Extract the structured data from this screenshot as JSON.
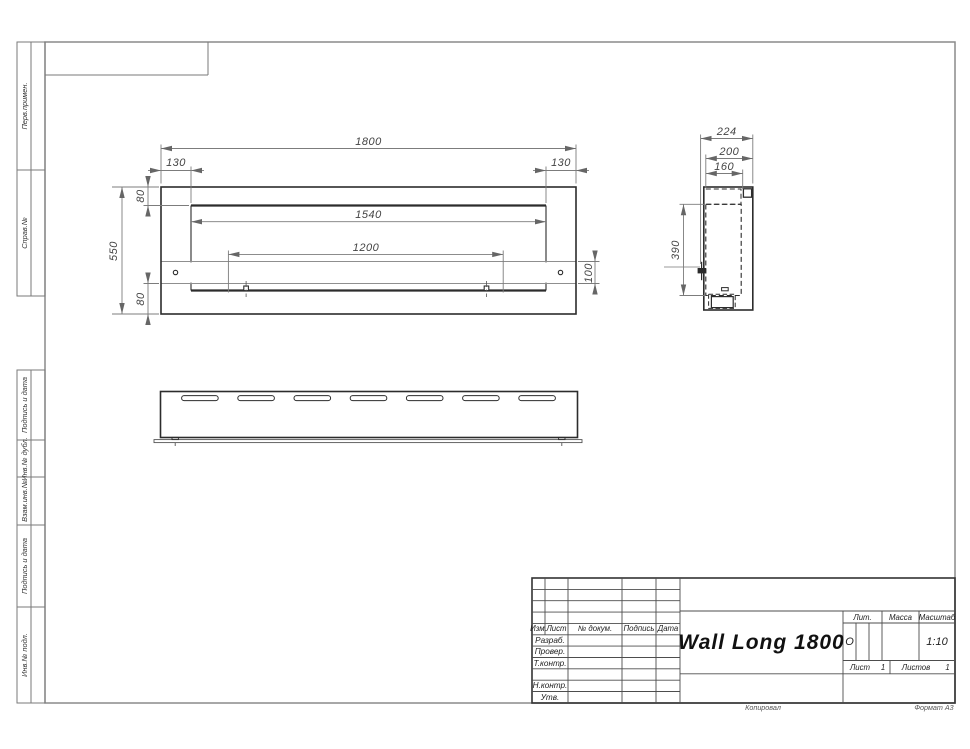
{
  "sheet": {
    "margin_labels": [
      "Перв.примен.",
      "Справ.№",
      "Подпись и дата",
      "Инв.№ дубл.",
      "Взам.инв.№",
      "Подпись и дата",
      "Инв.№ подл."
    ],
    "footer": {
      "copied_by": "Копировал",
      "format": "Формат А3"
    }
  },
  "drawing": {
    "front_view": {
      "overall_width": "1800",
      "side_offset_left": "130",
      "side_offset_right": "130",
      "top_inset": "80",
      "overall_height": "550",
      "opening_width": "1540",
      "mount_spacing": "1200",
      "bracket_height": "100",
      "bottom_inset": "80"
    },
    "side_view": {
      "overall_depth": "224",
      "body_depth": "200",
      "inner_depth": "160",
      "inner_height": "390"
    }
  },
  "title_block": {
    "header_cols": [
      "Изм.",
      "Лист",
      "№ докум.",
      "Подпись",
      "Дата"
    ],
    "row_labels": [
      "Разраб.",
      "Провер.",
      "Т.контр.",
      "Н.контр.",
      "Утв."
    ],
    "name": "Wall Long 1800",
    "lit_label": "Лит.",
    "lit_value": "О",
    "mass_label": "Масса",
    "scale_label": "Масштаб",
    "scale_value": "1:10",
    "sheet_label": "Лист",
    "sheet_number": "1",
    "sheets_label": "Листов",
    "sheets_total": "1"
  }
}
